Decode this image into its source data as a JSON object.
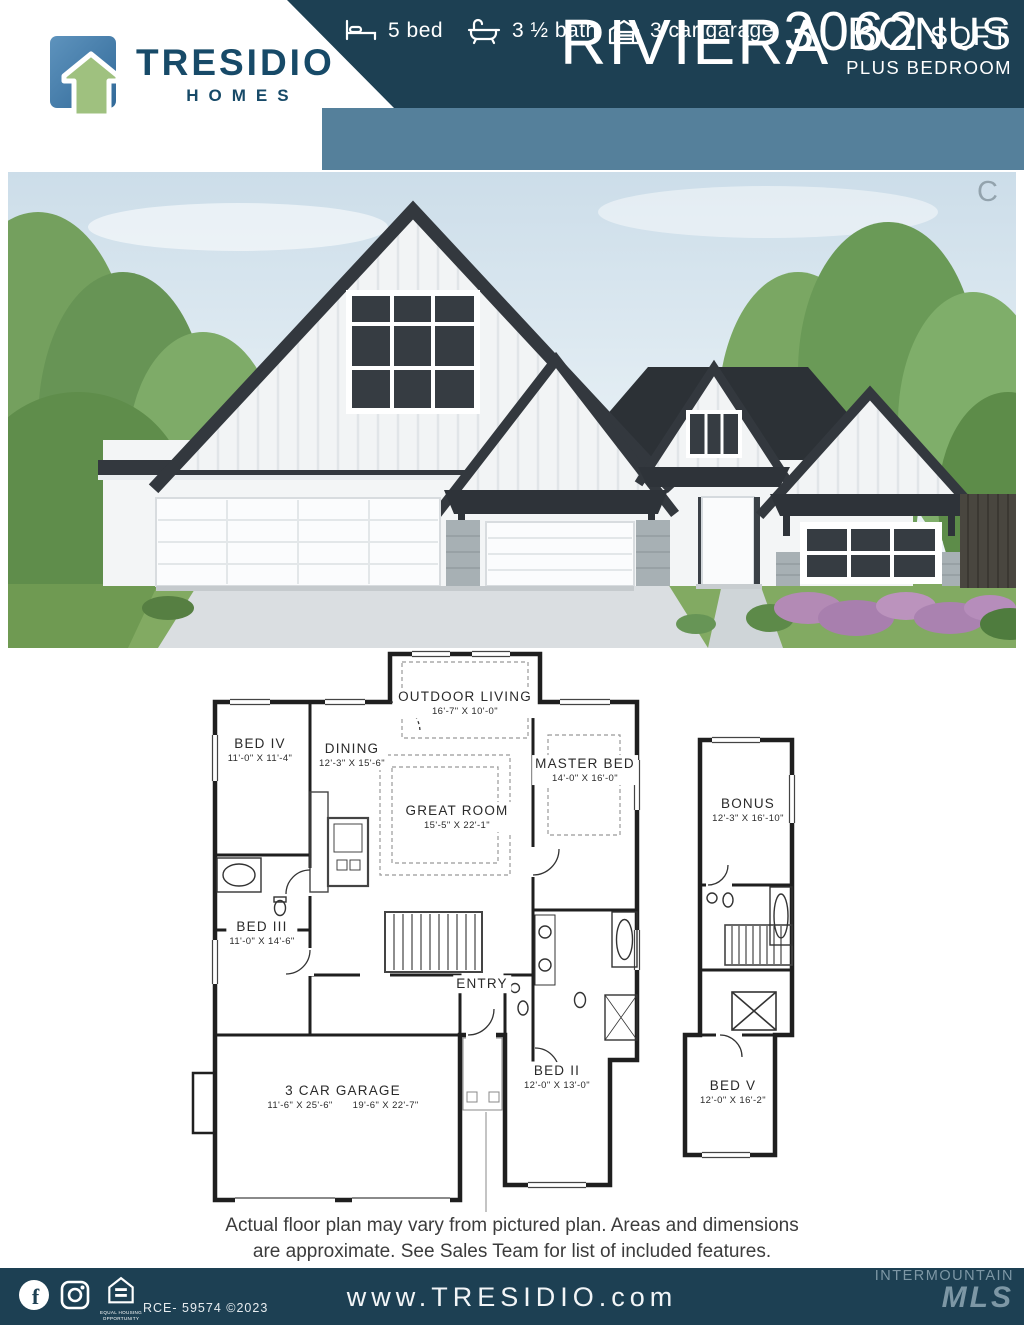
{
  "header": {
    "logo": {
      "brand": "TRESIDIO",
      "word": "HOMES"
    },
    "plan_name": "RIVIERA",
    "plan_variant": "BONUS",
    "plan_variant_sub": "PLUS BEDROOM",
    "features": [
      {
        "icon": "bed-icon",
        "label": "5 bed"
      },
      {
        "icon": "bath-icon",
        "label": "3 ½ bath"
      },
      {
        "icon": "garage-icon",
        "label": "3 car garage"
      }
    ],
    "sqft": {
      "value": "3062",
      "unit": "SQFT"
    }
  },
  "photo": {
    "watermark": "C"
  },
  "floorplan": {
    "rooms": [
      {
        "name": "OUTDOOR LIVING",
        "dims": "16'-7\" X 10'-0\""
      },
      {
        "name": "BED IV",
        "dims": "11'-0\" X 11'-4\""
      },
      {
        "name": "DINING",
        "dims": "12'-3\" X 15'-6\""
      },
      {
        "name": "GREAT ROOM",
        "dims": "15'-5\" X 22'-1\""
      },
      {
        "name": "MASTER BED",
        "dims": "14'-0\" X 16'-0\""
      },
      {
        "name": "BED III",
        "dims": "11'-0\" X 14'-6\""
      },
      {
        "name": "ENTRY",
        "dims": ""
      },
      {
        "name": "BED II",
        "dims": "12'-0\" X 13'-0\""
      },
      {
        "name": "3 CAR GARAGE",
        "dims": "11'-6\" X 25'-6\"",
        "dims2": "19'-6\" X 22'-7\""
      },
      {
        "name": "BONUS",
        "dims": "12'-3\" X 16'-10\""
      },
      {
        "name": "BED V",
        "dims": "12'-0\" X 16'-2\""
      }
    ]
  },
  "disclaimer": {
    "line1": "Actual floor plan may vary from pictured plan. Areas and dimensions",
    "line2": "are approximate. See Sales Team for list of included features."
  },
  "footer": {
    "website": "www.TRESIDIO.com",
    "license": "RCE- 59574 ©2023",
    "eho_line1": "EQUAL HOUSING",
    "eho_line2": "OPPORTUNITY",
    "mls_line1": "INTERMOUNTAIN",
    "mls_line2": "MLS"
  },
  "colors": {
    "navy": "#1d4053",
    "steel_blue": "#55809b",
    "logo_blue": "#4779a7",
    "logo_green": "#9fc17f",
    "brand_navy": "#174a68"
  }
}
